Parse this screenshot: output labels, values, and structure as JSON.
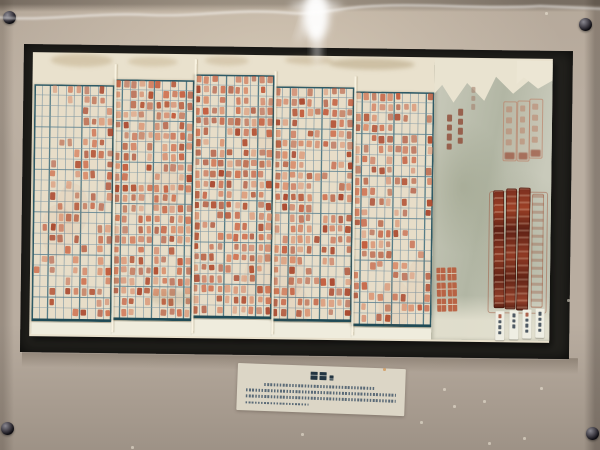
{
  "alt": "Museum display photo: an unfolded five-panel paper register filled with red handwritten characters in blue grid cells, a grey-green cover section at right bearing faint red seals, dark maroon seal strips, a red stamp and four small white slips; framed behind glass on a beige board with four black mounting pins and an illegible caption card below.",
  "colors": {
    "wall": "#b9ada0",
    "frame_dark": "#23221e",
    "paper": "#e9e1cd",
    "panel_paper": "#e7ddc8",
    "paper_bright": "#efecdd",
    "grid_line": "#7f98a4",
    "grid_line_dark": "#43707e",
    "grid_border": "#2e5a66",
    "cover_base": "#c9cabb",
    "cover_dark": "#b2b6a4",
    "seal_faint": "#b97c62",
    "stamp_red": "#b85433",
    "slip": "#efeee3",
    "slip_mark": "#32404d",
    "handwriting": "#8f4a36",
    "card": "#dcd6c6",
    "card_ink": "#44586a",
    "card_title": "#233541",
    "speck": "#efe8d8"
  },
  "ink_palette": [
    "#c2593a",
    "#cf7150",
    "#b04a2c",
    "#d98d6b",
    "#a8432a"
  ],
  "pins": [
    {
      "x": 9,
      "y": 17
    },
    {
      "x": 585,
      "y": 24
    },
    {
      "x": 7,
      "y": 428
    },
    {
      "x": 592,
      "y": 433
    }
  ],
  "panels": [
    {
      "left": 2,
      "top": 32,
      "width": 80,
      "height": 237,
      "cols": 10,
      "rows": 22,
      "density": 0.5,
      "seed": 11,
      "sparse_cols": [
        0,
        1
      ]
    },
    {
      "left": 82,
      "top": 26,
      "width": 80,
      "height": 241,
      "cols": 10,
      "rows": 23,
      "density": 0.72,
      "seed": 22,
      "sparse_cols": []
    },
    {
      "left": 162,
      "top": 20,
      "width": 80,
      "height": 244,
      "cols": 10,
      "rows": 23,
      "density": 0.78,
      "seed": 33,
      "sparse_cols": []
    },
    {
      "left": 242,
      "top": 31,
      "width": 80,
      "height": 235,
      "cols": 10,
      "rows": 22,
      "density": 0.74,
      "seed": 44,
      "sparse_cols": [
        5
      ]
    },
    {
      "left": 322,
      "top": 35,
      "width": 80,
      "height": 235,
      "cols": 10,
      "rows": 22,
      "density": 0.62,
      "seed": 55,
      "sparse_cols": [
        8
      ]
    }
  ],
  "stains": [
    {
      "x": 18,
      "y": 1,
      "w": 62,
      "h": 13,
      "c": "rgba(158,128,78,0.28)"
    },
    {
      "x": 95,
      "y": 3,
      "w": 50,
      "h": 10,
      "c": "rgba(158,128,78,0.24)"
    },
    {
      "x": 172,
      "y": 1,
      "w": 44,
      "h": 10,
      "c": "rgba(150,120,70,0.22)"
    },
    {
      "x": 252,
      "y": 0,
      "w": 48,
      "h": 9,
      "c": "rgba(150,120,70,0.25)"
    },
    {
      "x": 296,
      "y": 2,
      "w": 86,
      "h": 11,
      "c": "rgba(140,112,66,0.3)"
    },
    {
      "x": 120,
      "y": 236,
      "w": 44,
      "h": 16,
      "c": "rgba(150,130,90,0.18)"
    }
  ],
  "cover": {
    "handwriting": [
      {
        "x": 37,
        "y": 24,
        "marks": 3,
        "size": 4,
        "gap": 3,
        "color": "#a5826f",
        "opacity": 0.6
      },
      {
        "x": 24,
        "y": 46,
        "marks": 4,
        "size": 5,
        "gap": 3,
        "color": "#8f4a36",
        "opacity": 0.8
      },
      {
        "x": 13,
        "y": 52,
        "marks": 4,
        "size": 5,
        "gap": 3,
        "color": "#8f4a36",
        "opacity": 0.8
      }
    ],
    "faint_seals": [
      {
        "x": 69,
        "y": 38,
        "w": 12,
        "h": 58
      },
      {
        "x": 83,
        "y": 37,
        "w": 11,
        "h": 59
      },
      {
        "x": 95,
        "y": 35,
        "w": 12,
        "h": 58
      }
    ],
    "outline_seal": {
      "x": 56,
      "y": 128,
      "w": 57,
      "h": 120
    },
    "dark_seals": [
      {
        "x": 61,
        "y": 127,
        "w": 11,
        "h": 118,
        "tilt": -1
      },
      {
        "x": 73,
        "y": 125,
        "w": 11,
        "h": 121,
        "tilt": 0
      },
      {
        "x": 85,
        "y": 124,
        "w": 12,
        "h": 123,
        "tilt": 0.6
      }
    ],
    "pale_seal": {
      "x": 99,
      "y": 130,
      "w": 10,
      "h": 112
    },
    "stamp": {
      "x": 5,
      "y": 205,
      "w": 20,
      "h": 44,
      "rows": 3
    },
    "slips": [
      {
        "x": 64,
        "y": 248,
        "marks": 4,
        "red_top": true
      },
      {
        "x": 78,
        "y": 247,
        "marks": 3,
        "red_top": false
      },
      {
        "x": 91,
        "y": 246,
        "marks": 4,
        "red_top": true
      },
      {
        "x": 104,
        "y": 245,
        "marks": 4,
        "red_top": false
      }
    ]
  },
  "caption": {
    "title_blocks": [
      {
        "w": 7,
        "h": 8
      },
      {
        "w": 7,
        "h": 8
      },
      {
        "w": 4,
        "h": 5
      }
    ],
    "lines": [
      {
        "indent_pct": 12,
        "width_pct": 86
      },
      {
        "indent_pct": 0,
        "width_pct": 100
      },
      {
        "indent_pct": 0,
        "width_pct": 100
      },
      {
        "indent_pct": 0,
        "width_pct": 42
      }
    ]
  },
  "specks": [
    {
      "x": 545,
      "y": 12
    },
    {
      "x": 443,
      "y": 388
    },
    {
      "x": 483,
      "y": 400
    },
    {
      "x": 540,
      "y": 387
    },
    {
      "x": 523,
      "y": 437
    },
    {
      "x": 488,
      "y": 442
    },
    {
      "x": 383,
      "y": 368,
      "c": "#d29a5e"
    },
    {
      "x": 453,
      "y": 405
    },
    {
      "x": 131,
      "y": 446
    },
    {
      "x": 301,
      "y": 433
    },
    {
      "x": 567,
      "y": 299
    },
    {
      "x": 420,
      "y": 421
    }
  ]
}
